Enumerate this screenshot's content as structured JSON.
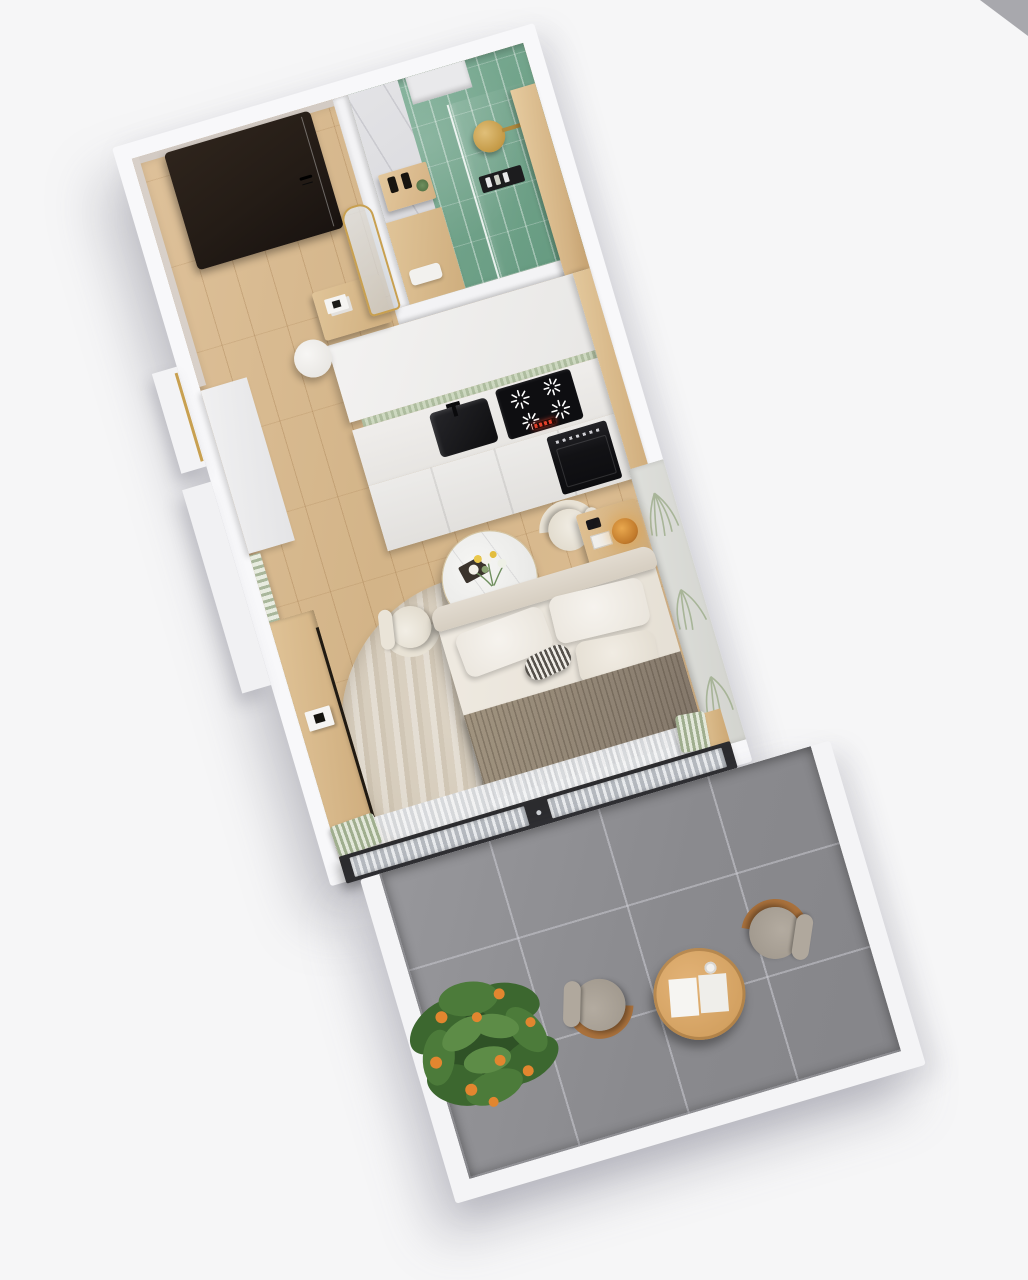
{
  "scene": {
    "type": "architectural-3d-floorplan-render",
    "view": "top-down axonometric render, unit rotated",
    "subject": "studio apartment with balcony",
    "rotation_deg": -16.5,
    "background_color": "#f6f6f7"
  },
  "palette": {
    "background": "#f6f6f7",
    "wall_white": "#f8f8fa",
    "entry_wall_beige": "#d3cbc4",
    "floor_wood": "#d7ba92",
    "furniture_wood": "#d9b887",
    "front_door_dark": "#241c16",
    "bathroom_tile_green": "#74a68c",
    "marble": "#dadadd",
    "kitchen_cabinet_white": "#ecebe9",
    "appliance_black": "#121215",
    "hob_display_red": "#e2402a",
    "backsplash_sage": "#b9c4ae",
    "bed_linen": "#e9e4db",
    "throw_taupe": "#95897a",
    "rug_beige": "#d8cfc0",
    "mural_leaf_sage": "#9fae8e",
    "balcony_tile_gray": "#8c8c90",
    "lounge_cushion_gray": "#a79f94",
    "lounge_frame_wood": "#a9713c",
    "coffee_table_wood": "#d9a868",
    "plant_green": "#4c7a3c",
    "citrus_orange": "#e08430",
    "brass_gold": "#c8a050",
    "door_frame_black": "#2c2c2f"
  },
  "rooms": [
    {
      "id": "entry-hall",
      "label": "Entry hall",
      "items": [
        "front door",
        "console table",
        "arch mirror",
        "round pouf"
      ]
    },
    {
      "id": "bathroom",
      "label": "Bathroom",
      "items": [
        "green tiled shower",
        "marble wall",
        "brass rain shower head",
        "glass partition",
        "wood vanity",
        "shelf with soap bottles",
        "toiletry caddy",
        "tall wood cabinet"
      ]
    },
    {
      "id": "kitchen",
      "label": "Kitchenette",
      "items": [
        "white cabinets",
        "sage tile backsplash",
        "black sink",
        "induction hob with red display",
        "built-in oven",
        "wood end panel"
      ]
    },
    {
      "id": "living-sleeping-area",
      "label": "Living / sleeping area",
      "items": [
        "double bed",
        "fringed taupe throw",
        "round rug",
        "nightstand",
        "amber table lamp",
        "round marble dining table",
        "two cream chairs",
        "flower bouquet",
        "window desk",
        "white built-in",
        "palm leaf mural wall",
        "sheer curtains",
        "glazed balcony doors"
      ]
    },
    {
      "id": "balcony",
      "label": "Balcony",
      "items": [
        "gray tile floor",
        "two lounge chairs",
        "round coffee table",
        "open magazine",
        "coffee cup",
        "citrus plant",
        "white parapet walls"
      ]
    }
  ]
}
